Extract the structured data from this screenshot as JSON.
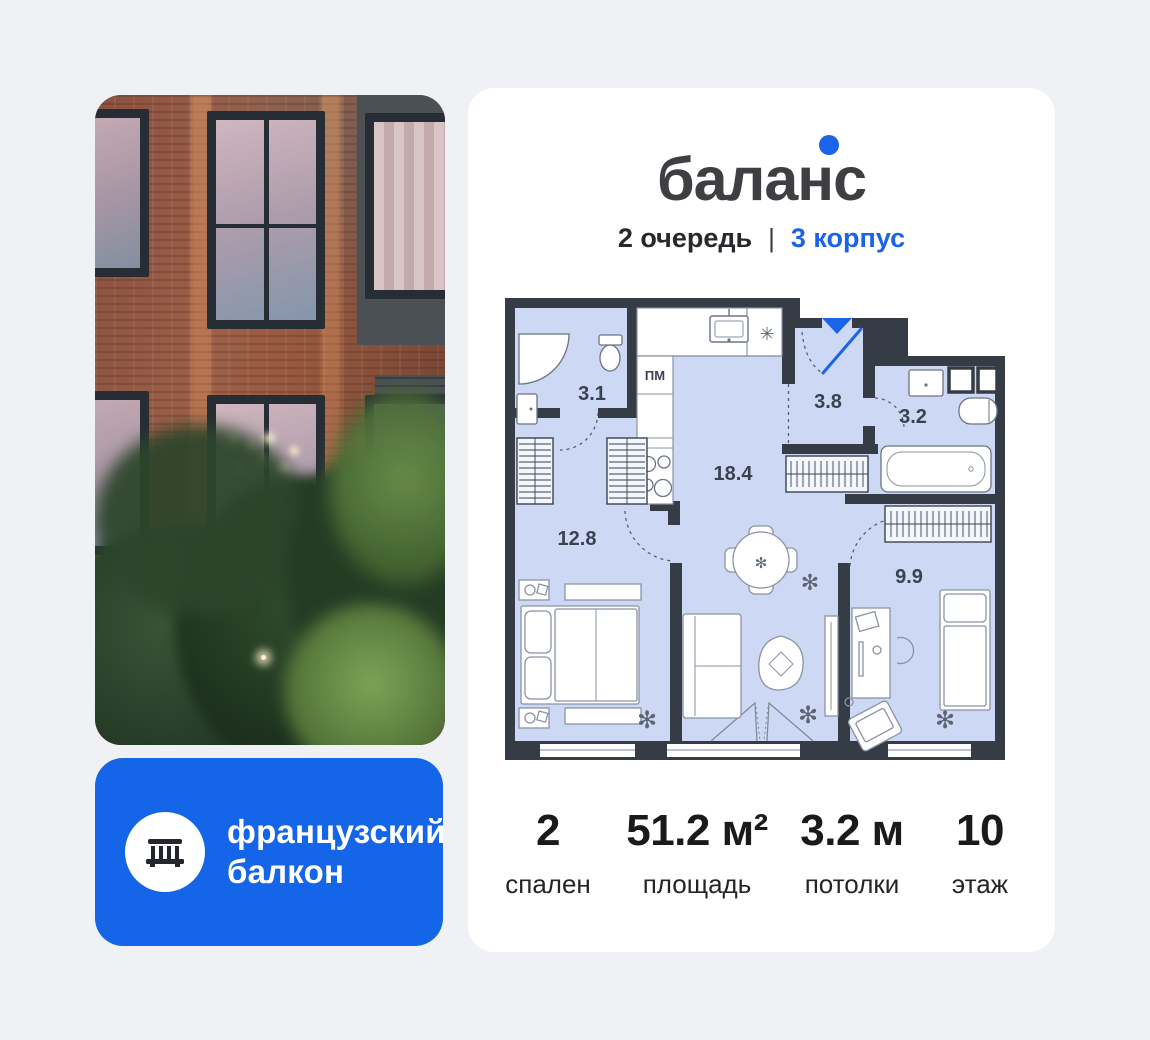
{
  "page": {
    "background": "#eff1f5"
  },
  "photo": {
    "description": "brick building facade at dusk with trees"
  },
  "feature_badge": {
    "line1": "французский",
    "line2": "балкон",
    "color": "#1565e8",
    "icon": "balcony-railing-icon"
  },
  "card": {
    "logo": {
      "text": "баланс",
      "dot_color": "#1b63e8"
    },
    "subtitle": {
      "phase": "2 очередь",
      "divider": "|",
      "building": "3 корпус",
      "building_color": "#1b63e8"
    },
    "floorplan": {
      "areas": {
        "bathroom1": "3.1",
        "hallway": "3.8",
        "bathroom2": "3.2",
        "kitchen_living": "18.4",
        "bedroom1": "12.8",
        "bedroom2": "9.9"
      },
      "kitchen_unit_label": "ПМ",
      "fridge_symbol": "✳",
      "plant_symbol": "✻",
      "colors": {
        "floor": "#cdd9f4",
        "wall": "#363c45",
        "accent": "#1b63e8"
      }
    },
    "stats": [
      {
        "value": "2",
        "label": "спален"
      },
      {
        "value": "51.2 м²",
        "label": "площадь"
      },
      {
        "value": "3.2 м",
        "label": "потолки"
      },
      {
        "value": "10",
        "label": "этаж"
      }
    ]
  }
}
